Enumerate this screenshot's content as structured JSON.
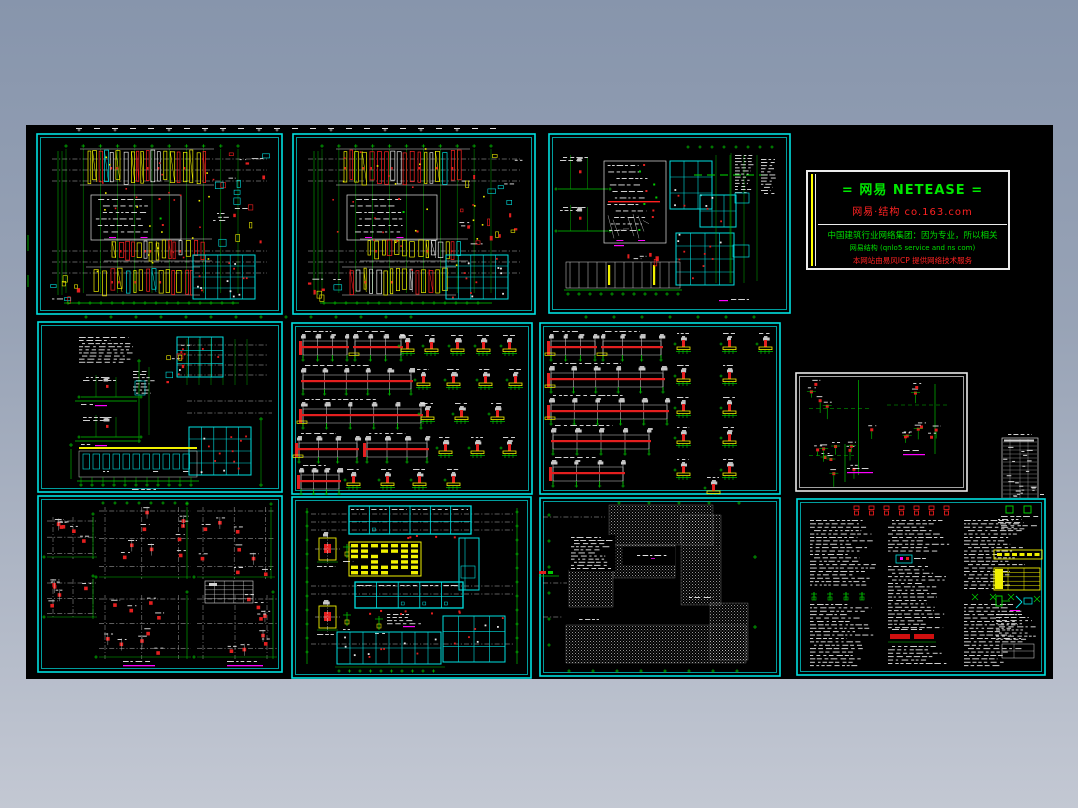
{
  "page": {
    "background_top_color": "#8795ac",
    "background_bottom_color": "#c3c8d3",
    "canvas_color": "#000000"
  },
  "palette": {
    "cyan": "#00e0e0",
    "green": "#00cc00",
    "green_dim": "#00b000",
    "red": "#ff2020",
    "red_fill": "#e41f1f",
    "yellow": "#f0f000",
    "white": "#e8e8e8",
    "gray": "#c8c8c8",
    "magenta": "#ff00ff"
  },
  "netease_panel": {
    "title": "= 网易  NETEASE =",
    "subtitle": "网易·结构  co.163.com",
    "slogan": "中国建筑行业网络集团：因为专业，所以相关",
    "url_line": "网易结构 (qnlo5 service and ns com)",
    "support_line": "本网站由易风ICP 提供网络技术服务"
  },
  "sheets": [
    {
      "id": "s1",
      "description": "framing plan with beam reinforcement"
    },
    {
      "id": "s2",
      "description": "framing plan with beam reinforcement"
    },
    {
      "id": "s3",
      "description": "partial framing plans and details"
    },
    {
      "id": "s4",
      "description": "roof framing plan and details"
    },
    {
      "id": "s5",
      "description": "beam elevations and column base details"
    },
    {
      "id": "s6",
      "description": "beam elevations and column base details"
    },
    {
      "id": "s7",
      "description": "column detail plan"
    },
    {
      "id": "s8",
      "description": "schedule table strip"
    },
    {
      "id": "s9",
      "description": "column layout plans"
    },
    {
      "id": "s10",
      "description": "floor plan with legend table"
    },
    {
      "id": "s11",
      "description": "foundation plan with hatched slabs"
    },
    {
      "id": "s12",
      "description": "general notes sheet"
    }
  ]
}
